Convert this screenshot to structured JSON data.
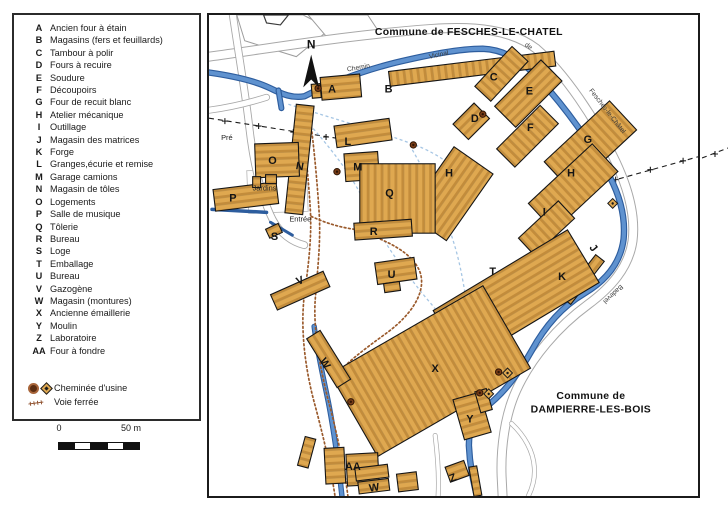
{
  "legend": {
    "items": [
      {
        "key": "A",
        "label": "Ancien four à étain"
      },
      {
        "key": "B",
        "label": "Magasins (fers et feuillards)"
      },
      {
        "key": "C",
        "label": "Tambour à polir"
      },
      {
        "key": "D",
        "label": "Fours à recuire"
      },
      {
        "key": "E",
        "label": "Soudure"
      },
      {
        "key": "F",
        "label": "Découpoirs"
      },
      {
        "key": "G",
        "label": "Four de recuit blanc"
      },
      {
        "key": "H",
        "label": "Atelier mécanique"
      },
      {
        "key": "I",
        "label": "Outillage"
      },
      {
        "key": "J",
        "label": "Magasin des matrices"
      },
      {
        "key": "K",
        "label": "Forge"
      },
      {
        "key": "L",
        "label": "Granges,écurie et remise"
      },
      {
        "key": "M",
        "label": "Garage camions"
      },
      {
        "key": "N",
        "label": "Magasin de tôles"
      },
      {
        "key": "O",
        "label": "Logements"
      },
      {
        "key": "P",
        "label": "Salle de musique"
      },
      {
        "key": "Q",
        "label": "Tôlerie"
      },
      {
        "key": "R",
        "label": "Bureau"
      },
      {
        "key": "S",
        "label": "Loge"
      },
      {
        "key": "T",
        "label": "Emballage"
      },
      {
        "key": "U",
        "label": "Bureau"
      },
      {
        "key": "V",
        "label": "Gazogène"
      },
      {
        "key": "W",
        "label": "Magasin (montures)"
      },
      {
        "key": "X",
        "label": "Ancienne émaillerie"
      },
      {
        "key": "Y",
        "label": "Moulin"
      },
      {
        "key": "Z",
        "label": "Laboratoire"
      },
      {
        "key": "AA",
        "label": "Four à fondre"
      }
    ],
    "symbols": [
      {
        "icon": "chimney-circle-and-diamond",
        "label": "Cheminée d'usine"
      },
      {
        "icon": "railway-ticks",
        "glyph": "++++",
        "label": "Voie ferrée"
      }
    ]
  },
  "scale_bar": {
    "start_label": "0",
    "end_label": "50 m"
  },
  "map": {
    "north_label": "N",
    "commune_top": "Commune de FESCHES-LE-CHATEL",
    "commune_bottom_line1": "Commune de",
    "commune_bottom_line2": "DAMPIERRE-LES-BOIS",
    "road_labels": [
      {
        "t": "Chemin",
        "x": 151,
        "y": 55,
        "r": -10
      },
      {
        "t": "Vicinal",
        "x": 232,
        "y": 42,
        "r": -12
      },
      {
        "t": "de",
        "x": 321,
        "y": 33,
        "r": 35
      },
      {
        "t": "Fesches-le-Châtel",
        "x": 400,
        "y": 98,
        "r": 52
      },
      {
        "t": "Badevel",
        "x": 406,
        "y": 280,
        "r": 137
      }
    ],
    "area_labels": [
      {
        "t": "Pré",
        "x": 18,
        "y": 126
      },
      {
        "t": "Jardins",
        "x": 56,
        "y": 177
      },
      {
        "t": "Entrée",
        "x": 92,
        "y": 208
      }
    ],
    "building_labels": [
      {
        "t": "A",
        "x": 124,
        "y": 78
      },
      {
        "t": "B",
        "x": 181,
        "y": 78
      },
      {
        "t": "C",
        "x": 287,
        "y": 66
      },
      {
        "t": "D",
        "x": 268,
        "y": 108
      },
      {
        "t": "E",
        "x": 323,
        "y": 80
      },
      {
        "t": "F",
        "x": 324,
        "y": 117
      },
      {
        "t": "G",
        "x": 382,
        "y": 129
      },
      {
        "t": "H",
        "x": 242,
        "y": 163
      },
      {
        "t": "H",
        "x": 365,
        "y": 163
      },
      {
        "t": "I",
        "x": 338,
        "y": 202
      },
      {
        "t": "J",
        "x": 385,
        "y": 237,
        "r": 50
      },
      {
        "t": "K",
        "x": 356,
        "y": 267
      },
      {
        "t": "L",
        "x": 140,
        "y": 131
      },
      {
        "t": "M",
        "x": 150,
        "y": 157
      },
      {
        "t": "N",
        "x": 91,
        "y": 156,
        "r": 10
      },
      {
        "t": "O",
        "x": 64,
        "y": 150
      },
      {
        "t": "P",
        "x": 24,
        "y": 188
      },
      {
        "t": "Q",
        "x": 182,
        "y": 183
      },
      {
        "t": "R",
        "x": 166,
        "y": 222
      },
      {
        "t": "S",
        "x": 66,
        "y": 227
      },
      {
        "t": "T",
        "x": 286,
        "y": 262
      },
      {
        "t": "U",
        "x": 184,
        "y": 265
      },
      {
        "t": "V",
        "x": 93,
        "y": 271,
        "r": -22
      },
      {
        "t": "W",
        "x": 114,
        "y": 353,
        "r": 58
      },
      {
        "t": "X",
        "x": 228,
        "y": 360
      },
      {
        "t": "Y",
        "x": 263,
        "y": 411
      },
      {
        "t": "Z",
        "x": 247,
        "y": 470,
        "r": -20
      },
      {
        "t": "AA",
        "x": 145,
        "y": 459
      },
      {
        "t": "W",
        "x": 167,
        "y": 480,
        "r": -8
      }
    ]
  },
  "colors": {
    "building_fill": "#DFA850",
    "building_stripe": "#C38C3B",
    "building_outline": "#151515",
    "river": "#5F92CF",
    "river_edge": "#2D5D9E",
    "water_channel_dashed": "#A6C6E4",
    "railway_dots": "#9A5A2C",
    "road_edge": "#A8A8A8",
    "boundary": "#1C1C1C"
  }
}
